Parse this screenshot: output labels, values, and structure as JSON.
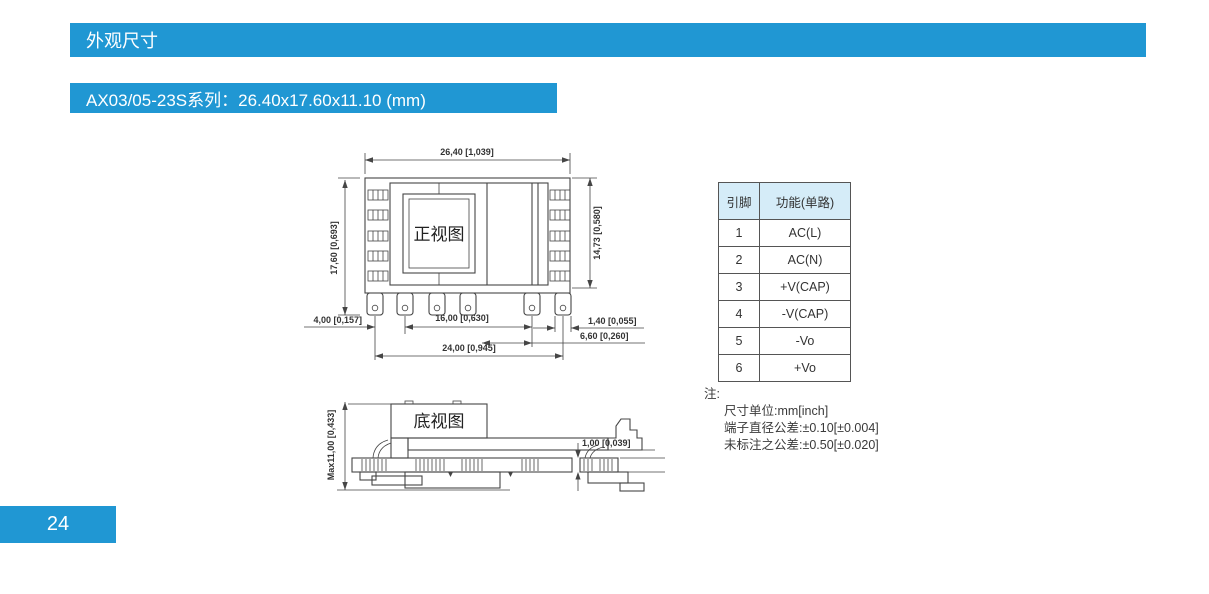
{
  "colors": {
    "accent": "#2097d3",
    "table_header_bg": "#d5ecf8"
  },
  "header": {
    "section_title": "外观尺寸",
    "series_title": "AX03/05-23S系列：26.40x17.60x11.10 (mm)"
  },
  "page_number": "24",
  "front_view": {
    "label": "正视图",
    "dim_width_top": "26,40 [1,039]",
    "dim_height_left": "17,60 [0,693]",
    "dim_height_right": "14,73 [0,580]",
    "dim_pin_pitch_left": "4,00 [0,157]",
    "dim_pin_span_inner": "16,00 [0,630]",
    "dim_pin_width": "1,40 [0,055]",
    "dim_pin_offset_right": "6,60 [0,260]",
    "dim_pin_span_outer": "24,00 [0,945]"
  },
  "bottom_view": {
    "label": "底视图",
    "dim_max_height": "Max11,00 [0,433]",
    "dim_standoff": "1,00 [0,039]"
  },
  "pin_table": {
    "headers": [
      "引脚",
      "功能(单路)"
    ],
    "rows": [
      [
        "1",
        "AC(L)"
      ],
      [
        "2",
        "AC(N)"
      ],
      [
        "3",
        "+V(CAP)"
      ],
      [
        "4",
        "-V(CAP)"
      ],
      [
        "5",
        "-Vo"
      ],
      [
        "6",
        "+Vo"
      ]
    ]
  },
  "notes": {
    "title": "注:",
    "lines": [
      "尺寸单位:mm[inch]",
      "端子直径公差:±0.10[±0.004]",
      "未标注之公差:±0.50[±0.020]"
    ]
  }
}
